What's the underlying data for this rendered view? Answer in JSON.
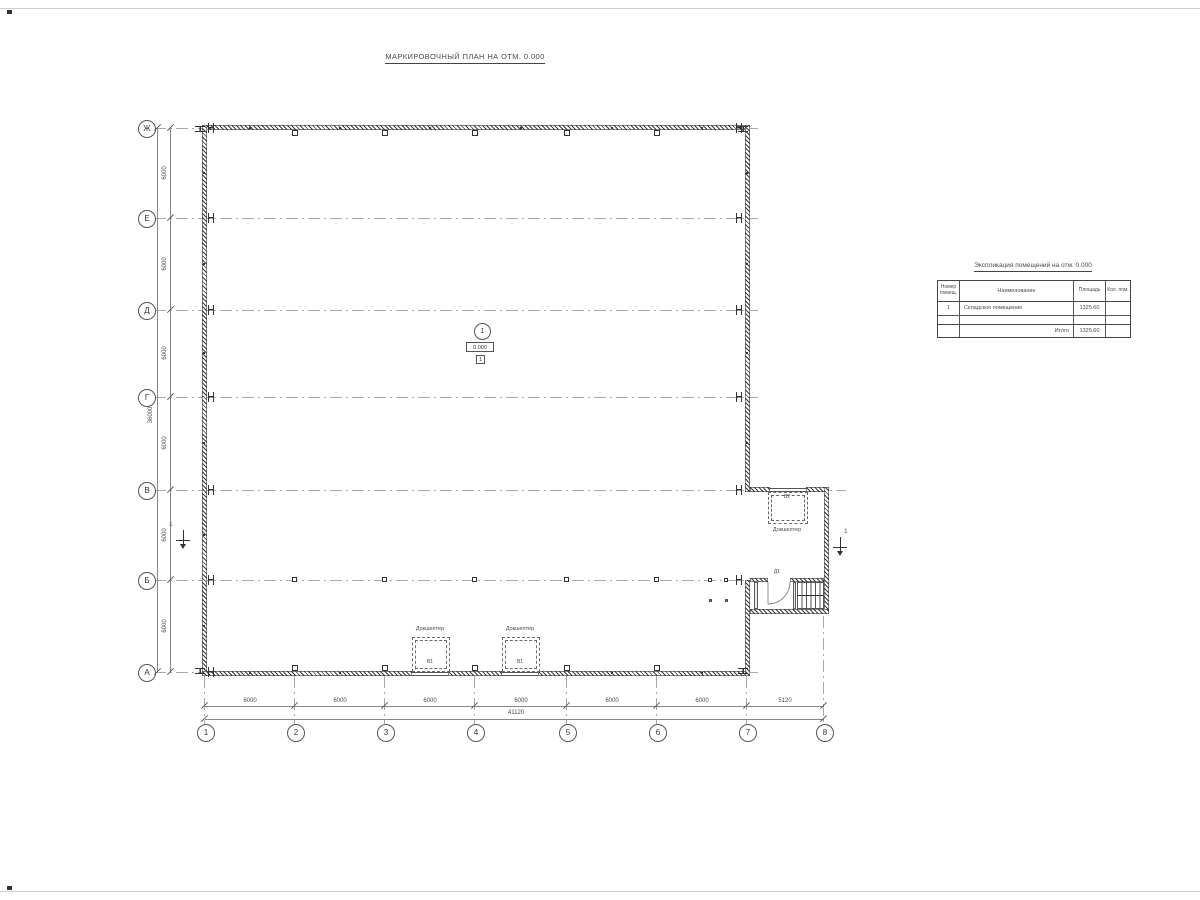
{
  "page": {
    "title": "МАРКИРОВОЧНЫЙ ПЛАН НА ОТМ. 0.000"
  },
  "plan": {
    "axes": {
      "rows": [
        "Ж",
        "Е",
        "Д",
        "Г",
        "В",
        "Б",
        "А"
      ],
      "cols": [
        "1",
        "2",
        "3",
        "4",
        "5",
        "6",
        "7",
        "8"
      ]
    },
    "dims": {
      "row_segments": [
        "6000",
        "6000",
        "6000",
        "6000",
        "6000",
        "6000"
      ],
      "row_total": "36000",
      "col_segments": [
        "6000",
        "6000",
        "6000",
        "6000",
        "6000",
        "6000",
        "5120"
      ],
      "col_total": "41120"
    },
    "room_tag": {
      "number": "1",
      "elevation": "0.000",
      "type": "1"
    },
    "section": {
      "label": "1"
    },
    "docks": [
      {
        "name": "Докшелтер",
        "mark": "В1"
      },
      {
        "name": "Докшелтер",
        "mark": "В1"
      },
      {
        "name": "Докшелтер",
        "mark": "В2"
      }
    ],
    "door_mark": "Д1"
  },
  "table": {
    "title": "Экспликация помещений на отм. 0.000",
    "col_headers": [
      "Номер помещ.",
      "Наименование",
      "Площадь",
      "Кол. пом."
    ],
    "rows": [
      [
        "1",
        "Складское помещение",
        "1325.60",
        ""
      ],
      [
        "",
        "",
        "",
        ""
      ]
    ],
    "total_label": "Итого",
    "total_value": "1325.60"
  }
}
